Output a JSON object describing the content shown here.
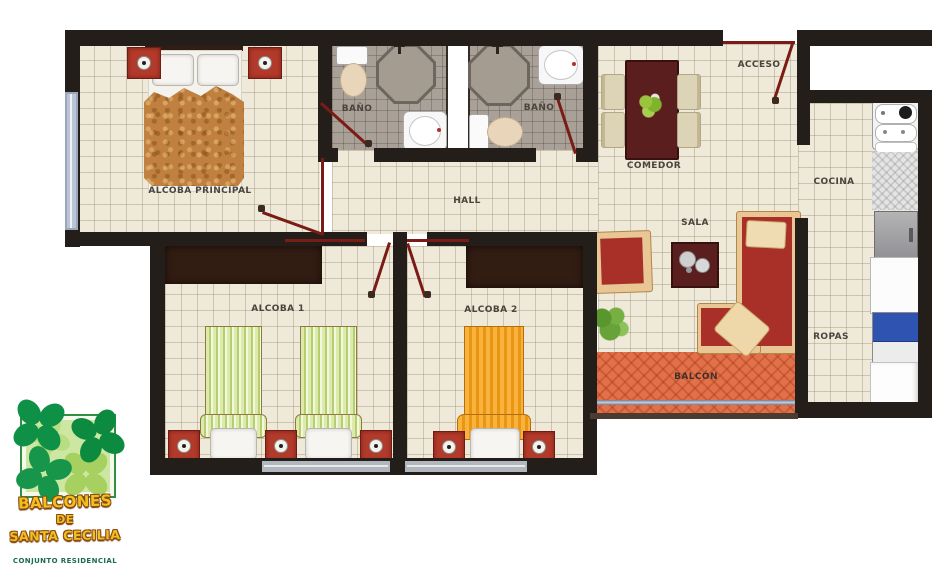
{
  "plan": {
    "labels": {
      "alcoba_principal": "ALCOBA PRINCIPAL",
      "bano_1": "BAÑO",
      "bano_2": "BAÑO",
      "hall": "HALL",
      "comedor": "COMEDOR",
      "acceso": "ACCESO",
      "cocina": "COCINA",
      "sala": "SALA",
      "ropas": "ROPAS",
      "alcoba_1": "ALCOBA 1",
      "alcoba_2": "ALCOBA 2",
      "balcon": "BALCÓN"
    },
    "colors": {
      "wall": "#241e1a",
      "floor_tile": "#efe9d9",
      "bath_floor": "#a9a197",
      "door_swing": "#7b1b16",
      "furniture_red": "#b23a2b",
      "sofa_red": "#a93028",
      "sofa_frame_tan": "#e8c795",
      "table_maroon": "#5a1e1e",
      "closet_brown": "#321d13",
      "balcony_terracotta": "#e2714a",
      "bed_green": "#c3d983",
      "bed_orange": "#f5a82c",
      "washer_blue": "#2e53b0",
      "window_blue": "#bac4d4",
      "plant_green": "#67a338"
    }
  },
  "logo": {
    "line1": "BALCONES",
    "line2": "DE",
    "line3": "SANTA CECILIA",
    "tagline": "CONJUNTO RESIDENCIAL",
    "clover_green": "#0e9147",
    "text_yellow": "#f2c01d"
  }
}
